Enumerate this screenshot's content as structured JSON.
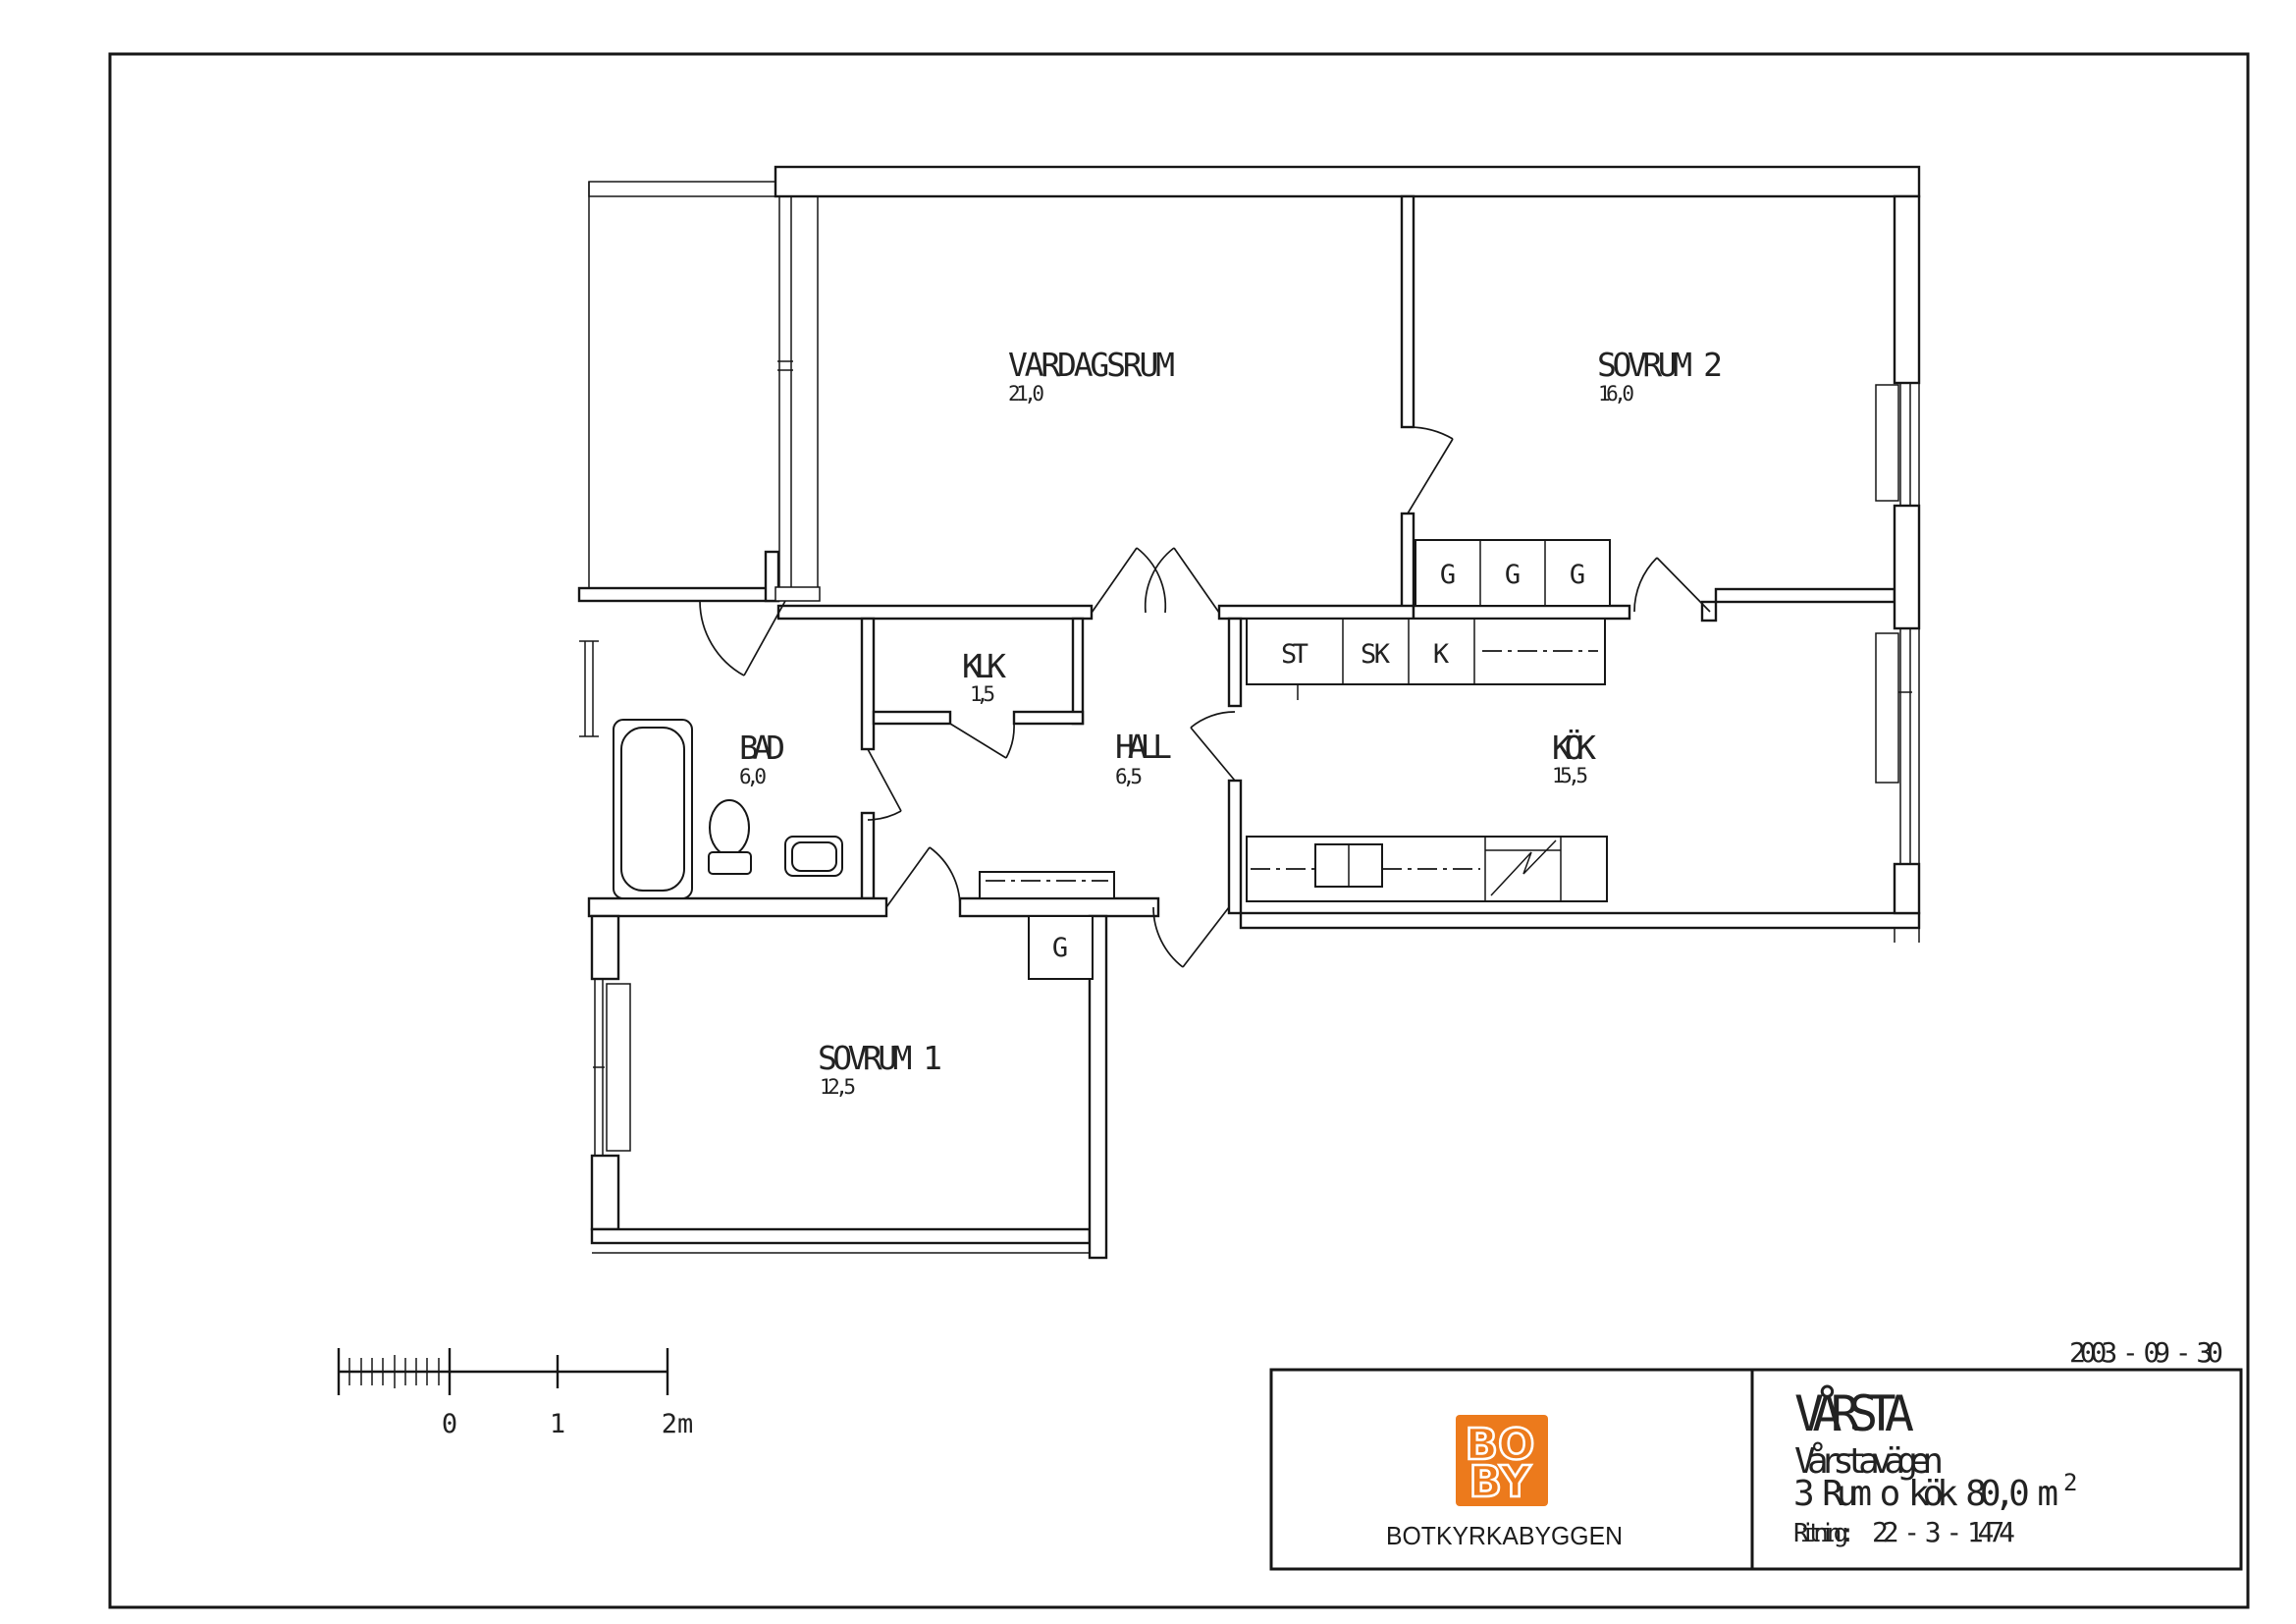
{
  "drawing": {
    "date": "2003 - 09 - 30",
    "rooms": [
      {
        "name": "VARDAGSRUM",
        "area": "21,0"
      },
      {
        "name": "SOVRUM 2",
        "area": "16,0"
      },
      {
        "name": "KÖK",
        "area": "15,5"
      },
      {
        "name": "HALL",
        "area": "6,5"
      },
      {
        "name": "KLK",
        "area": "1,5"
      },
      {
        "name": "BAD",
        "area": "6,0"
      },
      {
        "name": "SOVRUM 1",
        "area": "12,5"
      }
    ],
    "closets": {
      "sovrum2": [
        "G",
        "G",
        "G"
      ],
      "kitchen": [
        "ST",
        "SK",
        "K"
      ],
      "sovrum1": [
        "G"
      ]
    },
    "scale_bar": {
      "tick_labels": [
        "0",
        "1",
        "2m"
      ]
    }
  },
  "title_block": {
    "company": "BOTKYRKABYGGEN",
    "logo": {
      "line1": "BO",
      "line2": "BY",
      "color": "#EC7A1C"
    },
    "project": "VÅRSTA",
    "street": "Vårstavägen",
    "layout": "3 Rum o kök 80,0 m",
    "layout_superscript": "2",
    "drawing_label": "Ritning:",
    "drawing_number": "22 - 3 - 1474"
  }
}
